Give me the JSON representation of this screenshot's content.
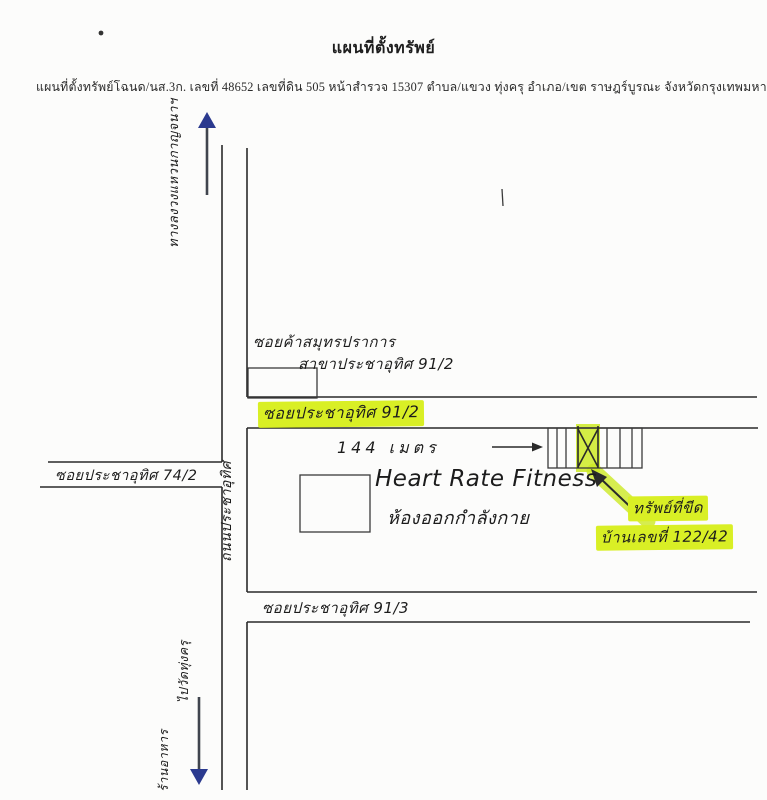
{
  "document": {
    "title": "แผนที่ตั้งทรัพย์",
    "subtitle": "แผนที่ตั้งทรัพย์โฉนด/นส.3ก. เลขที่ 48652  เลขที่ดิน 505  หน้าสำรวจ 15307  ตำบล/แขวง ทุ่งครุ  อำเภอ/เขต ราษฎร์บูรณะ  จังหวัดกรุงเทพมหานคร"
  },
  "map": {
    "roads": {
      "main_road": "ถนนประชาอุทิศ",
      "soi_74_2": "ซอยประชาอุทิศ 74/2",
      "soi_91_2": "ซอยประชาอุทิศ 91/2",
      "soi_91_3": "ซอยประชาอุทิศ 91/3"
    },
    "landmarks": {
      "shop_line1": "ซอยค้าสมุทรปราการ",
      "shop_line2": "สาขาประชาอุทิศ 91/2",
      "gym_name": "Heart Rate Fitness",
      "gym_desc": "ห้องออกกำลังกาย"
    },
    "annotations": {
      "distance": "144 เมตร",
      "marked_property": "ทรัพย์ที่ขีด",
      "house_number": "บ้านเลขที่ 122/42",
      "direction_up": "ทางลงวงแหวนกาญจนาฯ",
      "direction_down_place": "ไปวัดทุ่งครุ",
      "direction_down_label": "ร้านอาหาร"
    },
    "colors": {
      "highlighter": "#d9ef25",
      "arrow_head": "#2b3a8f",
      "ink": "#2a2a2a",
      "paper": "#fcfcfb"
    }
  }
}
